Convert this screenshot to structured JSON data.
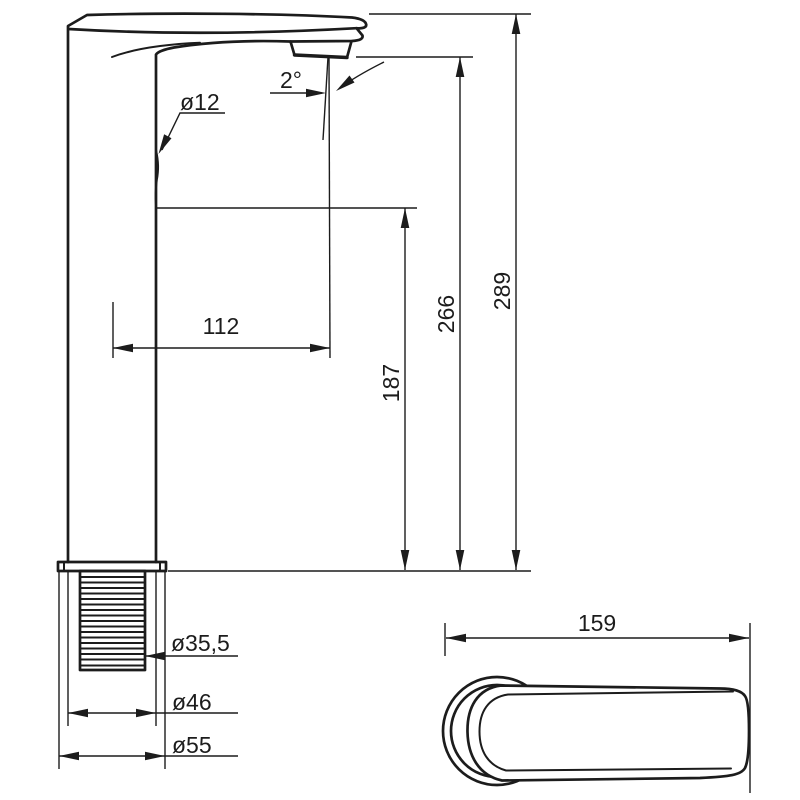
{
  "drawing": {
    "background": "#ffffff",
    "line_color": "#1c1c1c"
  },
  "dims": {
    "pipe_diameter": "ø12",
    "spray_angle": "2°",
    "spout_reach": "112",
    "outlet_height": "187",
    "spout_height": "266",
    "total_height": "289",
    "thread_diameter": "ø35,5",
    "body_diameter": "ø46",
    "base_diameter": "ø55",
    "handle_length": "159"
  }
}
